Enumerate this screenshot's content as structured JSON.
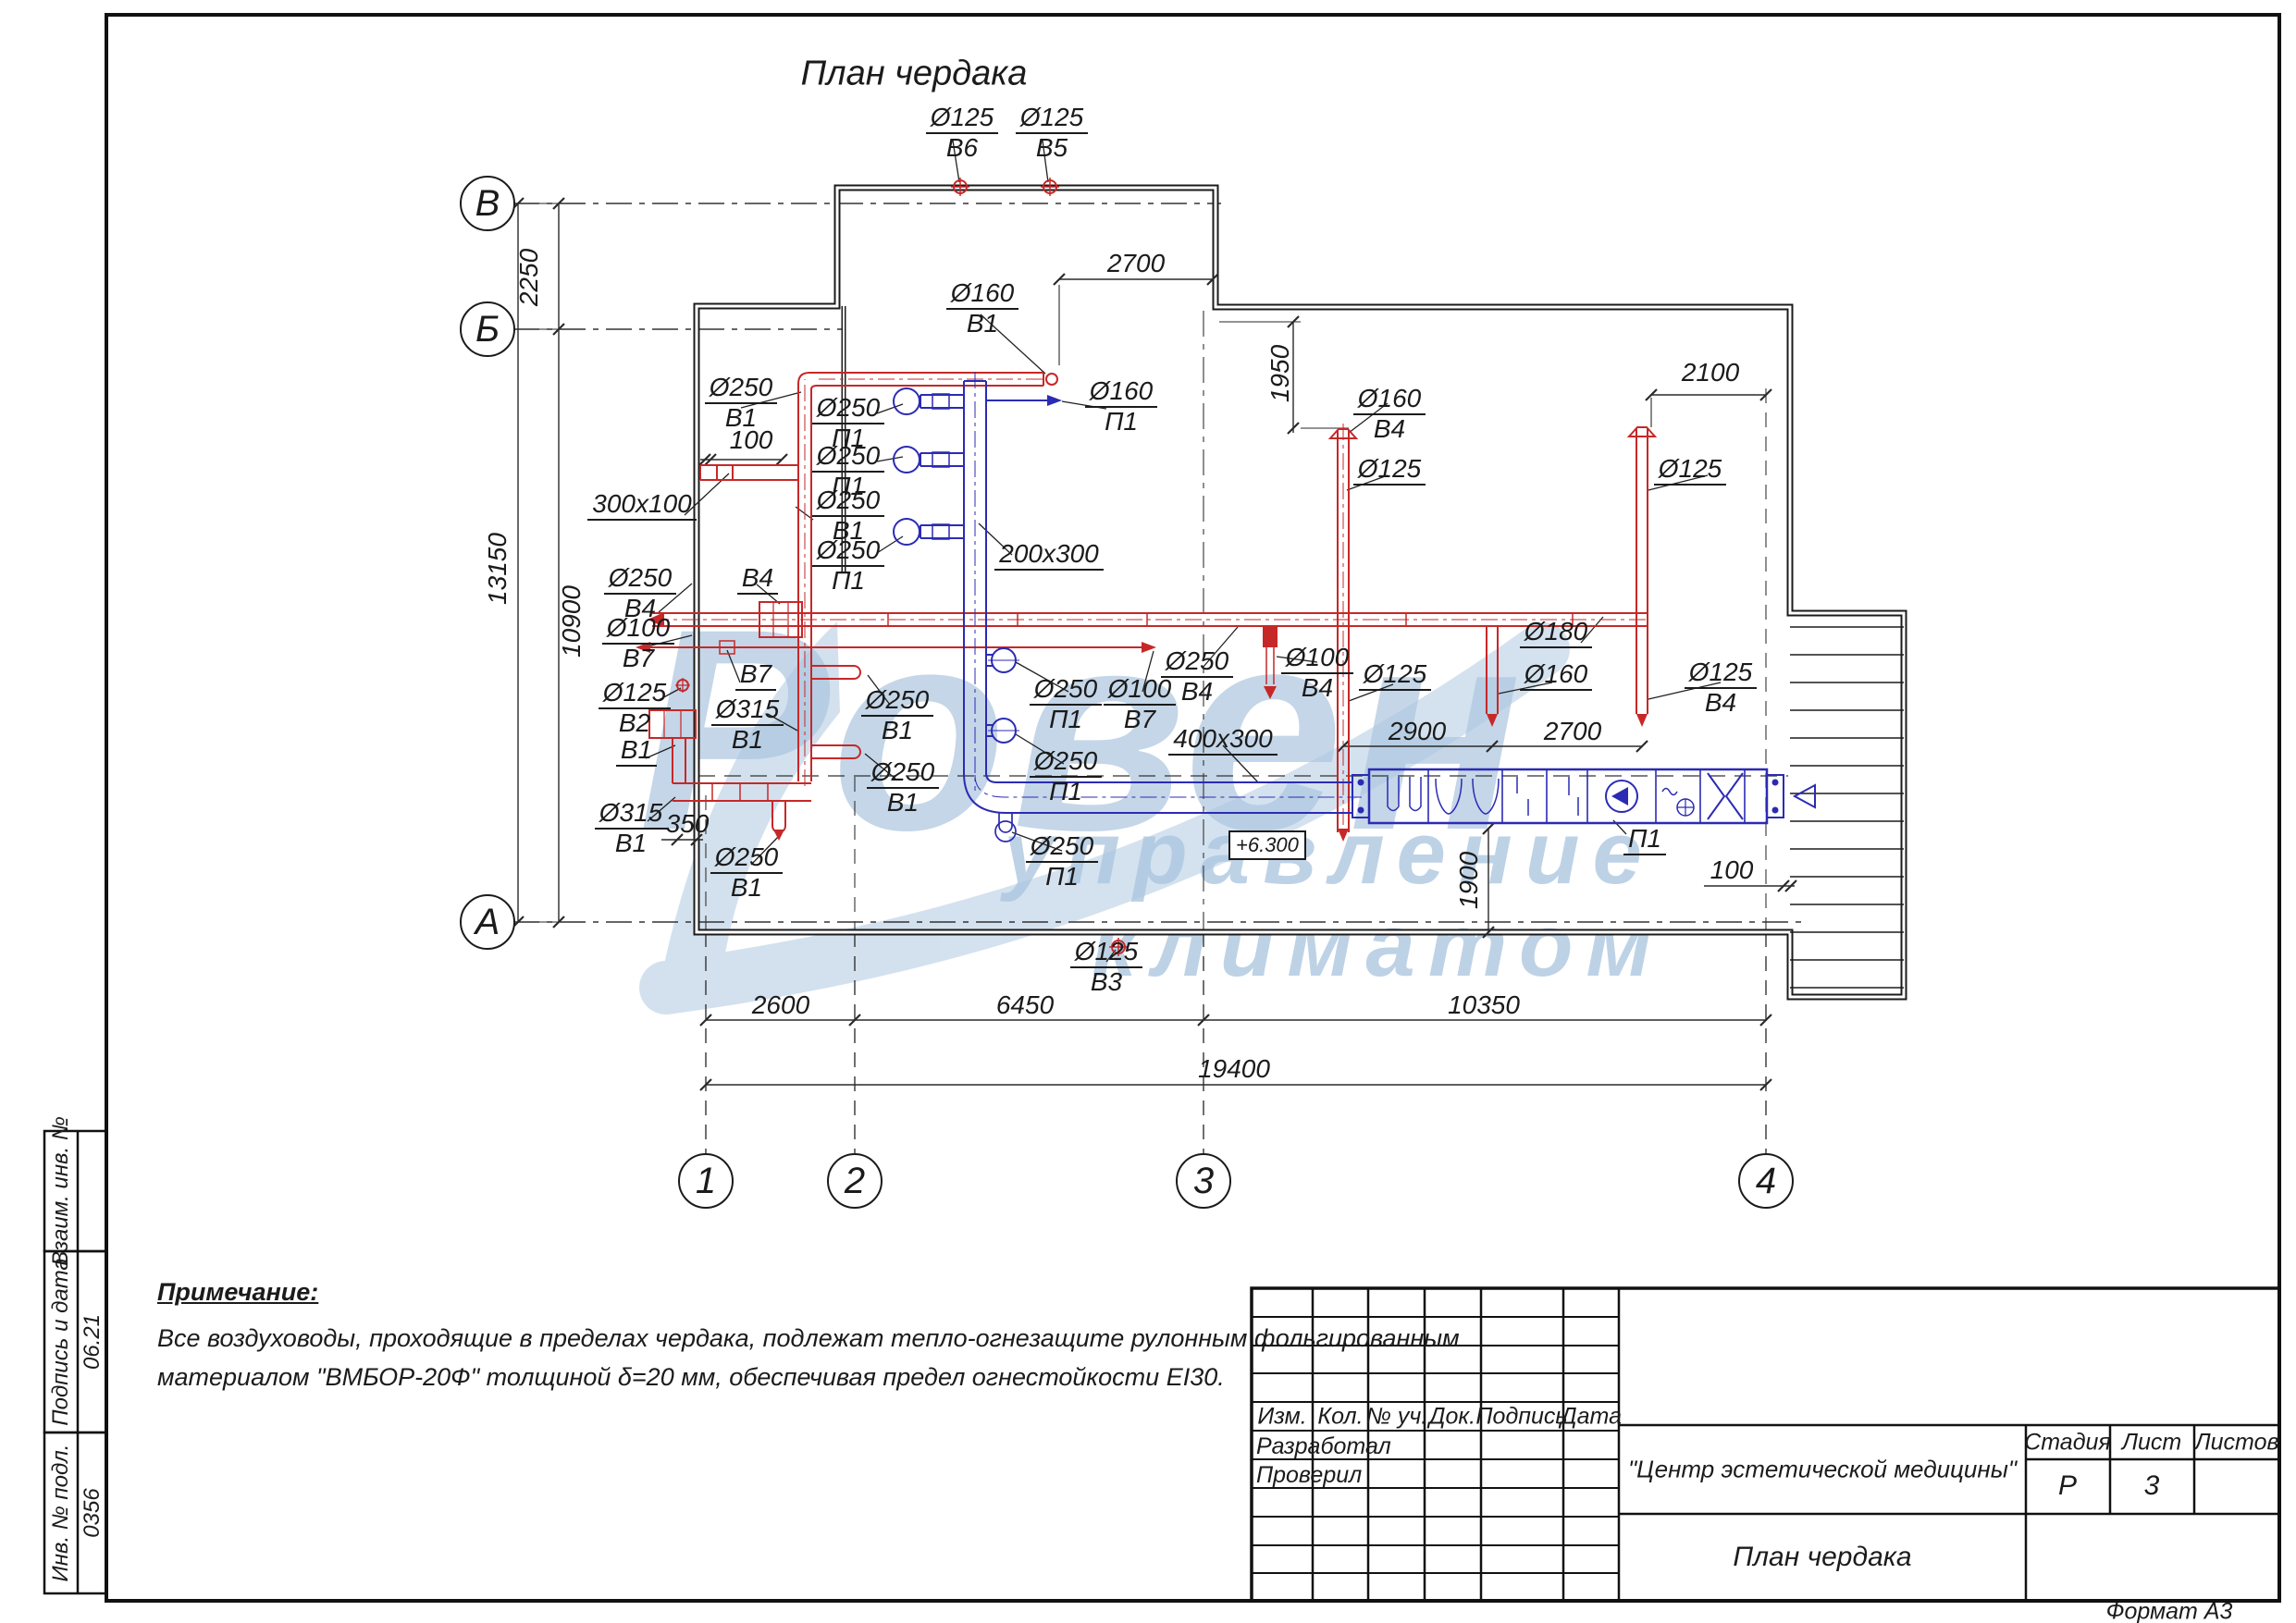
{
  "page": {
    "title": "План чердака",
    "format_note": "Формат А3"
  },
  "watermark": {
    "word": "Ровен",
    "sub1": "управление",
    "sub2": "климатом",
    "color": "#93b4d6"
  },
  "colors": {
    "exhaust_red": "#c62828",
    "supply_blue": "#2b2bb4",
    "line_black": "#1b1b1b"
  },
  "grid": {
    "rows": [
      "В",
      "Б",
      "А"
    ],
    "cols": [
      "1",
      "2",
      "3",
      "4"
    ]
  },
  "dims": {
    "left_top": "2250",
    "left_total": "13150",
    "left_bottom": "10900",
    "top_2700": "2700",
    "right_1950": "1950",
    "right_2100": "2100",
    "small_100_left": "100",
    "mid_2900": "2900",
    "mid_2700": "2700",
    "mid_1900": "1900",
    "right_100": "100",
    "small_350": "350",
    "bottom_2600": "2600",
    "bottom_6450": "6450",
    "bottom_10350": "10350",
    "bottom_19400": "19400",
    "elevation": "+6.300"
  },
  "duct_labels": [
    {
      "size": "Ø125",
      "sys": "В6"
    },
    {
      "size": "Ø125",
      "sys": "В5"
    },
    {
      "size": "Ø160",
      "sys": "В1"
    },
    {
      "size": "Ø160",
      "sys": "П1"
    },
    {
      "size": "Ø250",
      "sys": "В1"
    },
    {
      "size": "Ø250",
      "sys": "П1"
    },
    {
      "size": "Ø250",
      "sys": "П1"
    },
    {
      "size": "Ø250",
      "sys": "В1"
    },
    {
      "size": "Ø250",
      "sys": "П1"
    },
    {
      "size": "200x300",
      "sys": ""
    },
    {
      "size": "300x100",
      "sys": ""
    },
    {
      "size": "Ø160",
      "sys": "В4"
    },
    {
      "size": "Ø125",
      "sys": ""
    },
    {
      "size": "Ø125",
      "sys": ""
    },
    {
      "size": "Ø250",
      "sys": "В4"
    },
    {
      "size": "В4",
      "sys": ""
    },
    {
      "size": "Ø100",
      "sys": "В7"
    },
    {
      "size": "В7",
      "sys": ""
    },
    {
      "size": "Ø125",
      "sys": "В2"
    },
    {
      "size": "В1",
      "sys": ""
    },
    {
      "size": "Ø315",
      "sys": "В1"
    },
    {
      "size": "Ø250",
      "sys": "В1"
    },
    {
      "size": "Ø250",
      "sys": "В1"
    },
    {
      "size": "Ø315",
      "sys": "В1"
    },
    {
      "size": "Ø250",
      "sys": "В1"
    },
    {
      "size": "Ø250",
      "sys": "П1"
    },
    {
      "size": "Ø100",
      "sys": "В7"
    },
    {
      "size": "Ø250",
      "sys": "В4"
    },
    {
      "size": "Ø100",
      "sys": "В4"
    },
    {
      "size": "400x300",
      "sys": ""
    },
    {
      "size": "Ø250",
      "sys": "П1"
    },
    {
      "size": "Ø250",
      "sys": "П1"
    },
    {
      "size": "Ø125",
      "sys": ""
    },
    {
      "size": "Ø160",
      "sys": ""
    },
    {
      "size": "Ø125",
      "sys": "В4"
    },
    {
      "size": "Ø180",
      "sys": ""
    },
    {
      "size": "П1",
      "sys": ""
    },
    {
      "size": "Ø125",
      "sys": "В3"
    }
  ],
  "note": {
    "heading": "Примечание:",
    "line1": "Все воздуховоды, проходящие в пределах чердака, подлежат тепло-огнезащите рулонным фольгированным",
    "line2": " материалом \"ВМБОР-20Ф\" толщиной δ=20 мм, обеспечивая предел огнестойкости EI30."
  },
  "sidebar": {
    "cap1": "Взаим. инв. №",
    "cap2": "Подпись и дата",
    "val2": "06.21",
    "cap3": "Инв. № подл.",
    "val3": "0356"
  },
  "stamp": {
    "cols": [
      "Изм.",
      "Кол.",
      "№ уч.",
      "Док.",
      "Подпись",
      "Дата"
    ],
    "row_dev": "Разработал",
    "row_chk": "Проверил",
    "project": "\"Центр эстетической медицины\"",
    "stage_h": "Стадия",
    "sheet_h": "Лист",
    "sheets_h": "Листов",
    "stage": "Р",
    "sheet": "3",
    "sheets": "",
    "doc_title": "План чердака"
  }
}
